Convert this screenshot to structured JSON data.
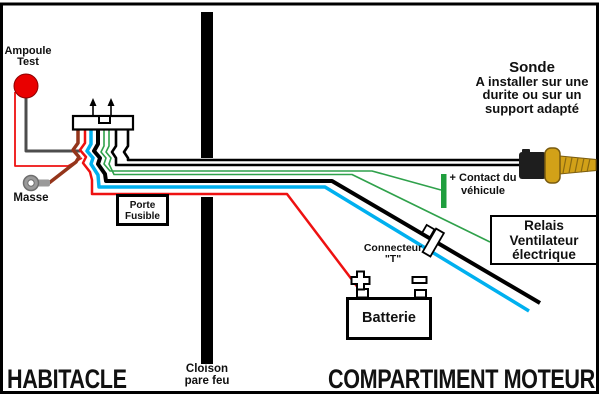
{
  "diagram": {
    "title_context": "Schéma de câblage ventilateur électrique",
    "zones": {
      "left": "HABITACLE",
      "right": "COMPARTIMENT MOTEUR",
      "divider_line1": "Cloison",
      "divider_line2": "pare feu"
    },
    "labels": {
      "ampoule_line1": "Ampoule",
      "ampoule_line2": "Test",
      "masse": "Masse",
      "porte_fusible_line1": "Porte",
      "porte_fusible_line2": "Fusible",
      "sonde_line1": "Sonde",
      "sonde_line2": "A installer sur une",
      "sonde_line3": "durite ou sur un",
      "sonde_line4": "support adapté",
      "contact_line1": "+ Contact du",
      "contact_line2": "véhicule",
      "relais_line1": "Relais",
      "relais_line2": "Ventilateur",
      "relais_line3": "électrique",
      "connecteur_line1": "Connecteur",
      "connecteur_line2": "\"T\"",
      "batterie": "Batterie",
      "battery_plus_symbol": "+",
      "battery_minus_symbol": "−"
    },
    "colors": {
      "wire_red": "#ee1111",
      "wire_brown": "#94351b",
      "wire_cyan": "#00b0ef",
      "wire_green": "#2fa14b",
      "wire_black": "#000000",
      "wire_gray": "#4d4d4d",
      "bulb_red": "#e90000",
      "terminal_gray": "#9a9a9a",
      "contact_green": "#1f9e3d",
      "brass": "#d2a118",
      "brass_dark": "#7a5c10",
      "connector_dark": "#1e1e1e",
      "border_black": "#000000"
    }
  }
}
